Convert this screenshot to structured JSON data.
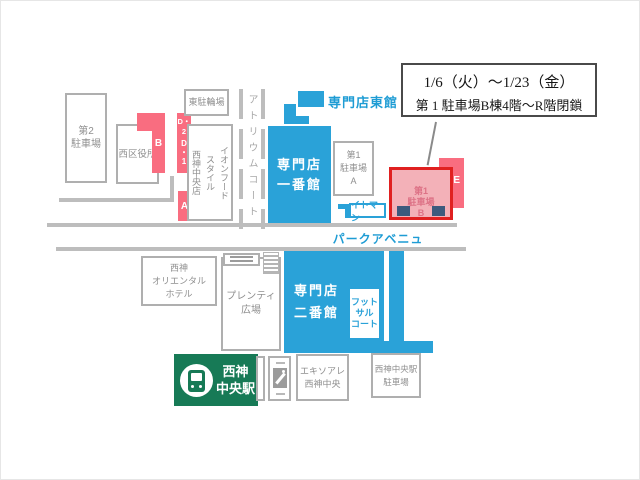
{
  "colors": {
    "blue": "#2AA2D8",
    "blue_text": "#1E9CD4",
    "pink": "#F96D80",
    "pink_light": "#F3B1B8",
    "red_border": "#E02020",
    "navy": "#3C5A7D",
    "green": "#177A56",
    "road_gray": "#BDBDBD",
    "border_gray": "#AFAFAF",
    "text_gray": "#8F8F8F"
  },
  "annotation": {
    "line1": "1/6（火）～1/23（金）",
    "line2": "第 1 駐車場B棟4階～R階閉鎖"
  },
  "zones": {
    "c": "C",
    "b": "B",
    "d2": "D・2",
    "d1": "D\n・\n1",
    "a": "A",
    "e": "E"
  },
  "places": {
    "parking2": "第2\n駐車場",
    "ward_office": "西区役所",
    "east_bicycle_parking": "東駐輪場",
    "aeon_food_style": "イオンフード\nスタイル\n西神中央店",
    "atrium_court": "アトリウムコート",
    "senmonten_east": "専門店東館",
    "senmonten_1": "専門店\n一番館",
    "parking1_a": "第1\n駐車場\nA",
    "itoman": "イトマン",
    "parking1_b": "第1\n駐車場\nB",
    "park_avenue": "パークアベニュー",
    "hotel": "西神\nオリエンタル\nホテル",
    "plenty_square": "プレンティ\n広場",
    "senmonten_2": "専門店\n二番館",
    "futsal_court": "フット\nサル\nコート",
    "station": "西神\n中央駅",
    "ekisoare": "エキソアレ\n西神中央",
    "station_parking": "西神中央駅\n駐車場"
  }
}
